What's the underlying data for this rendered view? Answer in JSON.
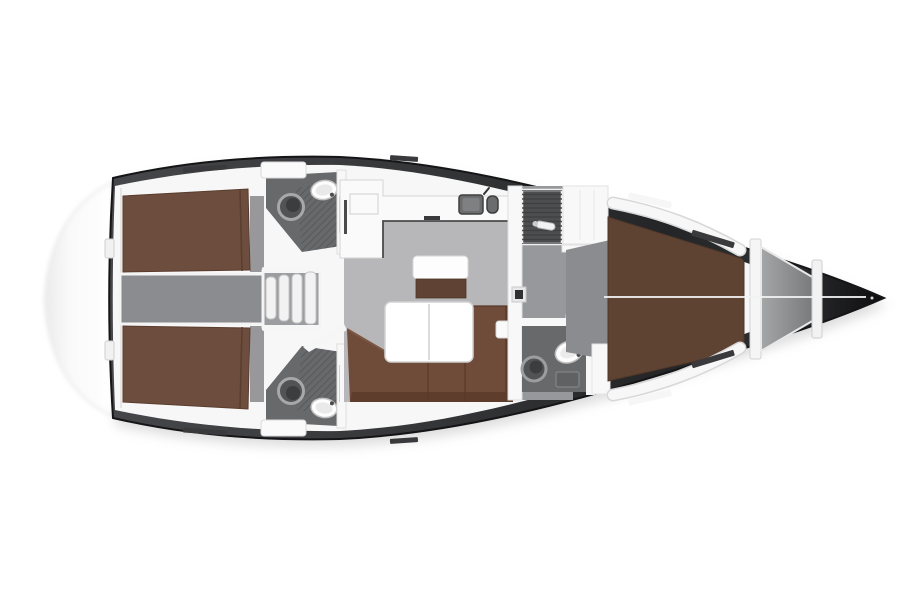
{
  "meta": {
    "diagram_type": "yacht-interior-floor-plan",
    "view": "top-down",
    "orientation": "bow-right"
  },
  "features": [
    "swim-platform",
    "transom",
    "aft-cabin-port",
    "aft-cabin-starboard",
    "engine-compartment",
    "companionway-steps",
    "head-aft-port",
    "head-aft-starboard",
    "galley",
    "galley-sink",
    "salon",
    "salon-table",
    "salon-sofa",
    "nav-seat",
    "bulkhead",
    "shower-forward",
    "corridor",
    "cabin-doors",
    "head-forward",
    "forward-cabin",
    "v-berth",
    "anchor-locker",
    "bow"
  ],
  "colors": {
    "background": "#ffffff",
    "hull_outline": "#151517",
    "shadow": "#b0b0b0",
    "deck_white": "#f7f7f7",
    "platform_fill": "#fbfbfb",
    "platform_edge": "#e2e2e2",
    "cabin_floor": "#98989b",
    "engine_floor": "#8a8c8f",
    "salon_floor": "#b7b7b9",
    "corridor_floor": "#96989b",
    "head_floor": "#67696b",
    "shower_floor": "#4c4e50",
    "steps_floor": "#9b9da0",
    "step_white": "#f2f2f2",
    "step_edge": "#c4c4c4",
    "wall_white": "#f8f8f8",
    "wall_edge": "#dedede",
    "berth_aft": "#6d4d3d",
    "berth_seam": "#5a3d2e",
    "berth_fwd": "#5e4232",
    "sofa": "#6f4b39",
    "sofa_back": "#5e3d2d",
    "seat_chart": "#5f4233",
    "table_white": "#ffffff",
    "table_edge": "#d2d2d2",
    "counter_white": "#fafafa",
    "counter_edge": "#4a4a4a",
    "sink_metal": "#6a6c6e",
    "fixture_dark": "#515355",
    "fixture_inner": "#3b3d3f",
    "fixture_ring": "#a6a8aa",
    "sink_white": "#fdfdfd",
    "sink_edge": "#c0c0c0",
    "track_dark": "#3a3a3c",
    "hatch_dark": "#303032",
    "centerline": "#f2f2f2"
  }
}
